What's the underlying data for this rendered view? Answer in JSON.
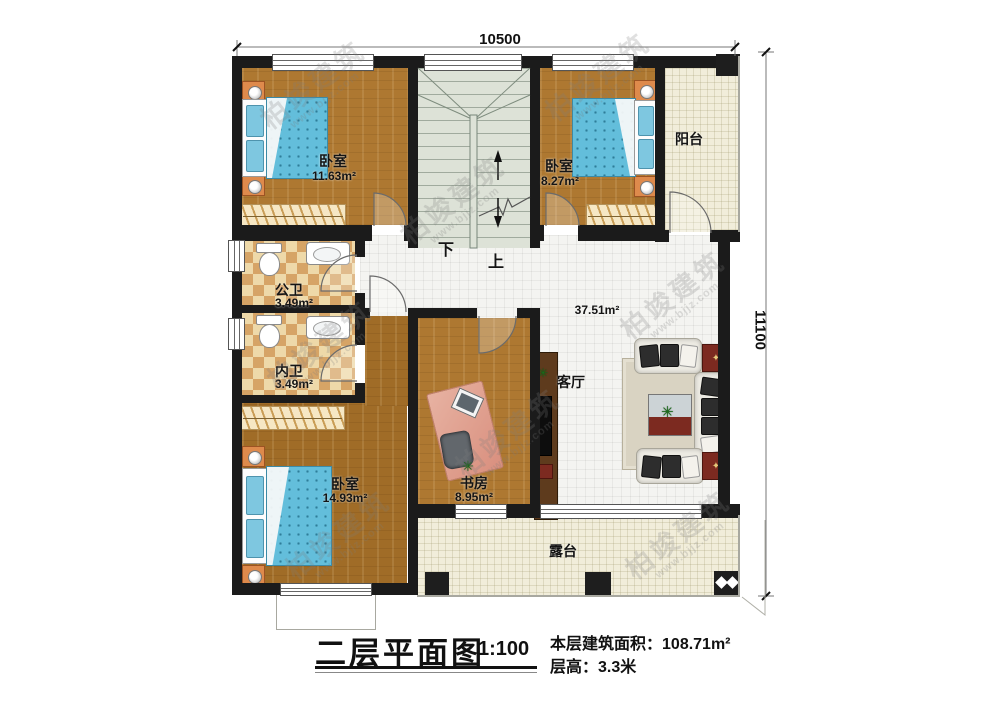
{
  "plan": {
    "dimension_top": "10500",
    "dimension_right": "11100",
    "stairs_down": "下",
    "stairs_up": "上",
    "rooms": [
      {
        "id": "bedroom-top-left",
        "name": "卧室",
        "area": "11.63m²"
      },
      {
        "id": "bedroom-top-right",
        "name": "卧室",
        "area": "8.27m²"
      },
      {
        "id": "balcony",
        "name": "阳台",
        "area": ""
      },
      {
        "id": "bath-public",
        "name": "公卫",
        "area": "3.49m²"
      },
      {
        "id": "bath-inner",
        "name": "内卫",
        "area": "3.49m²"
      },
      {
        "id": "bedroom-bottom-left",
        "name": "卧室",
        "area": "14.93m²"
      },
      {
        "id": "study",
        "name": "书房",
        "area": "8.95m²"
      },
      {
        "id": "living-room",
        "name": "客厅",
        "area": "37.51m²"
      },
      {
        "id": "terrace",
        "name": "露台",
        "area": ""
      }
    ]
  },
  "title_block": {
    "title": "二层平面图",
    "scale": "1:100",
    "area_label": "本层建筑面积：",
    "area_value": "108.71m²",
    "floor_height_label": "层高：",
    "floor_height_value": "3.3米"
  },
  "watermark": {
    "name": "柏竣建筑",
    "url": "www.bjjz.com"
  },
  "colors": {
    "wall": "#1b1b1b",
    "wood_floor": "#ae7831",
    "white_tile": "#f4f4f1",
    "cream_tile": "#f1edda",
    "bath_checker": "#d6a466",
    "stair": "#dde2d7",
    "bed_blue": "#63bedb",
    "nightstand_orange": "#de8a4c",
    "accent_red": "#7c2a20"
  }
}
